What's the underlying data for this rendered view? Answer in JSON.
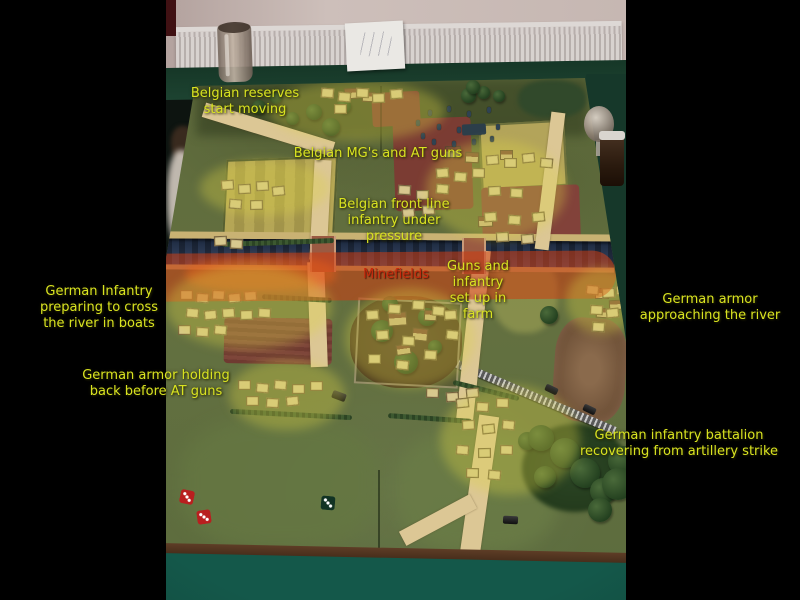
{
  "annotations": {
    "belgian_reserves": {
      "lines": [
        "Belgian reserves",
        "start moving"
      ]
    },
    "belgian_mg_at_guns": {
      "lines": [
        "Belgian MG's and AT guns"
      ]
    },
    "belgian_front_line": {
      "lines": [
        "Belgian front line",
        "infantry under",
        "pressure"
      ]
    },
    "minefields": {
      "lines": [
        "Minefields"
      ]
    },
    "guns_infantry_farm": {
      "lines": [
        "Guns and",
        "infantry",
        "set up in",
        "farm"
      ]
    },
    "german_infantry_crossing": {
      "lines": [
        "German Infantry",
        "preparing to cross",
        "the river in boats"
      ]
    },
    "german_armor_approaching": {
      "lines": [
        "German armor",
        "approaching the river"
      ]
    },
    "german_armor_holding": {
      "lines": [
        "German armor holding",
        "back before AT guns"
      ]
    },
    "german_infantry_recovering": {
      "lines": [
        "German infantry battalion",
        "recovering from artillery strike"
      ]
    }
  },
  "colors": {
    "annotation_yellow": "#d9e321",
    "annotation_red": "#c8290c",
    "highlight_yellow": "rgba(219,212,70,0.34)",
    "minefield_band": "rgba(207,60,16,0.55)",
    "river_blue": "#2c3a54",
    "board_green": "#637040",
    "road_tan": "#dcc795",
    "table_cloth_green": "#14584a"
  }
}
